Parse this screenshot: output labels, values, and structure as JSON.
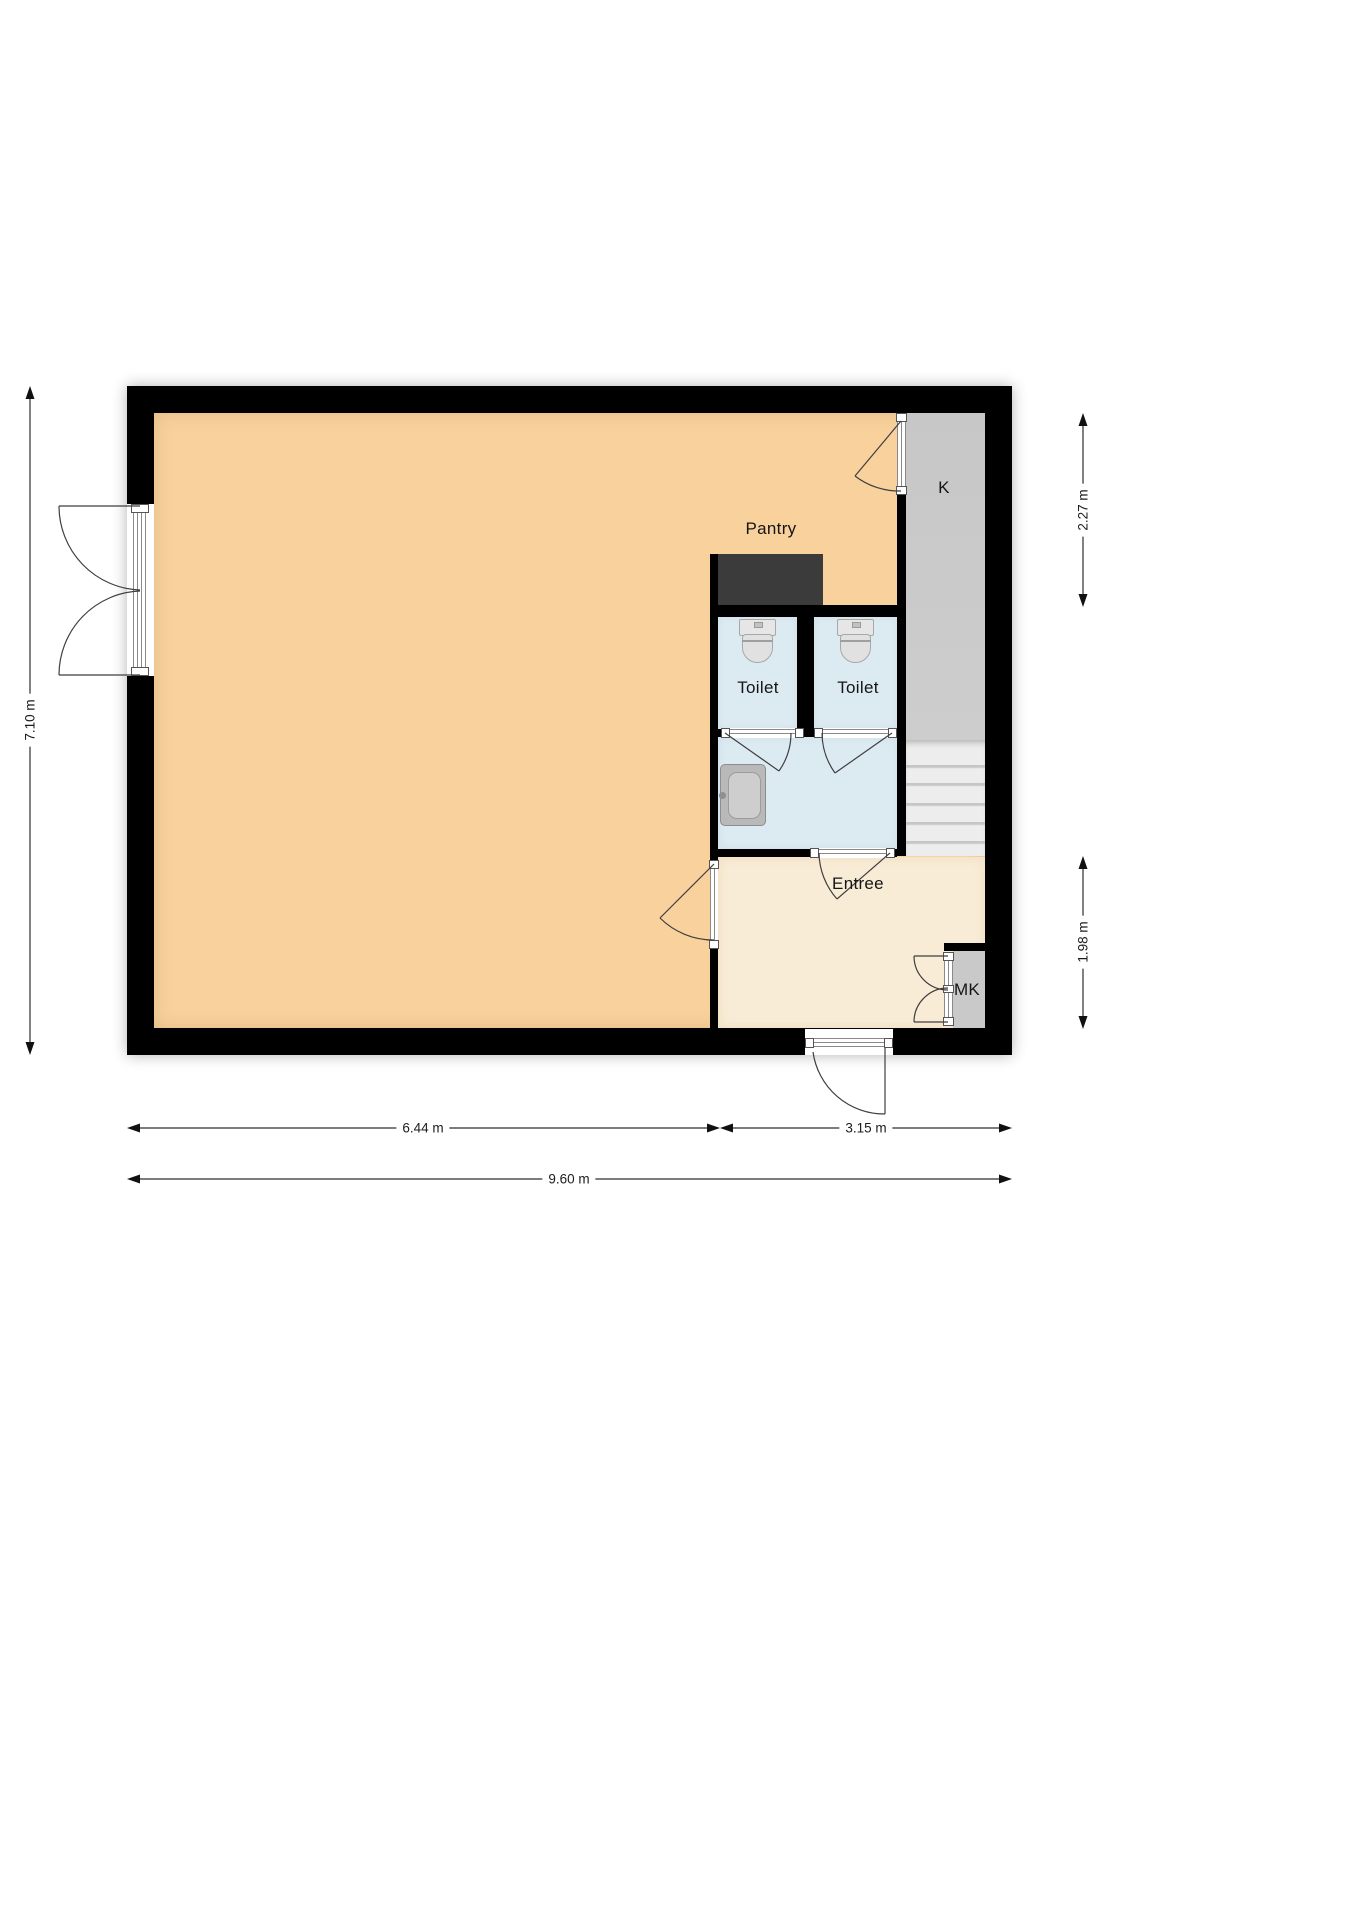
{
  "plan": {
    "labels": {
      "pantry": "Pantry",
      "toilet_left": "Toilet",
      "toilet_right": "Toilet",
      "entree": "Entree",
      "k": "K",
      "mk": "MK"
    },
    "dimensions": {
      "height_total": "7.10 m",
      "right_top": "2.27 m",
      "right_bottom": "1.98 m",
      "bottom_left": "6.44 m",
      "bottom_right": "3.15 m",
      "bottom_total": "9.60 m"
    },
    "colors": {
      "wall": "#000000",
      "main_floor": "#f8d19d",
      "entree_floor": "#f9ecd6",
      "wet_room_floor": "#dceaf2",
      "closet_floor": "#c9c9c9",
      "stairs_floor": "#ededed",
      "counter": "#3b3b3b"
    },
    "icons": {
      "toilet": "toilet-icon",
      "sink": "sink-icon",
      "stairs": "stairs-treads",
      "doors": "door-swing-arc"
    }
  }
}
